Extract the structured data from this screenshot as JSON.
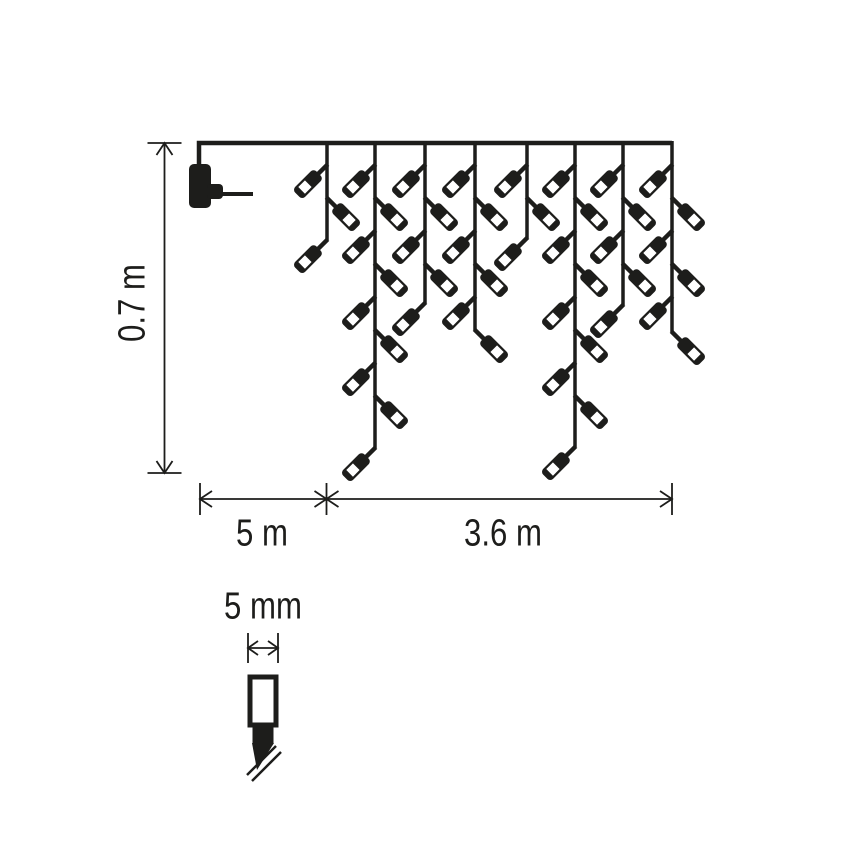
{
  "colors": {
    "ink": "#1d1d1b",
    "paper": "#ffffff"
  },
  "canvas": {
    "w": 868,
    "h": 868
  },
  "labels": {
    "drop_height": "0.7 m",
    "lead_length": "5 m",
    "curtain_length": "3.6 m",
    "bulb_width": "5 mm"
  },
  "wire": {
    "y": 143,
    "x1": 199,
    "x2": 672,
    "stroke": 4.5
  },
  "plug": {
    "drop_x": 199,
    "drop_y2": 170,
    "body": {
      "x": 189,
      "y": 164,
      "w": 22,
      "h": 44,
      "r": 5
    },
    "prong": {
      "x": 207,
      "y": 184,
      "w": 16,
      "h": 15,
      "r": 4
    },
    "pin": {
      "x": 222,
      "y": 192,
      "w": 31,
      "h": 4
    }
  },
  "strands": {
    "stroke": 3.5,
    "top": 141,
    "items": [
      {
        "x": 327,
        "end": 240
      },
      {
        "x": 375,
        "end": 448
      },
      {
        "x": 425,
        "end": 303
      },
      {
        "x": 475,
        "end": 330
      },
      {
        "x": 527,
        "end": 238
      },
      {
        "x": 575,
        "end": 447
      },
      {
        "x": 623,
        "end": 305
      },
      {
        "x": 672,
        "end": 332
      }
    ]
  },
  "bulb_rule": {
    "first_y": 165,
    "step": 33,
    "end_margin": 30,
    "start_side": "L"
  },
  "bulb_shape": {
    "wire": {
      "x": -2.2,
      "y": -1,
      "w": 4.4,
      "h": 16
    },
    "body": {
      "x": -7,
      "y": 12,
      "w": 14,
      "h": 30,
      "r": 4
    },
    "window": {
      "x": -4.7,
      "y": 26.5,
      "w": 9.4,
      "h": 9.4
    }
  },
  "dimensions": {
    "stroke": 1.8,
    "arrow": {
      "back": 12,
      "perp": 8
    },
    "vertical": {
      "x": 164.5,
      "y1": 143,
      "y2": 473,
      "tick_half": 17,
      "label_cx": 133,
      "label_cy": 303
    },
    "horizontal": {
      "y": 499,
      "x1": 200,
      "x_mid": 326.5,
      "x2": 672,
      "tick_half": 16,
      "lead_label_cx": 262,
      "curtain_label_cx": 503,
      "label_cy": 534
    },
    "detail": {
      "arrow_y": 648,
      "x1": 248,
      "x2": 278,
      "tick_half": 15,
      "arrow_back": 10,
      "arrow_perp": 7,
      "label_cx": 263,
      "label_cy": 607
    }
  },
  "detail_bulb": {
    "glass": {
      "x": 250,
      "y": 677,
      "w": 26,
      "h": 48,
      "stroke": 5
    },
    "base": {
      "x": 252.5,
      "y": 723,
      "w": 21,
      "h": 21
    },
    "cone": "252,743 274,743 257,770",
    "wire_lines": [
      {
        "x1": 276,
        "y1": 746,
        "x2": 247,
        "y2": 775
      },
      {
        "x1": 281,
        "y1": 752,
        "x2": 252,
        "y2": 781
      }
    ],
    "wire_stroke": 2.5
  }
}
